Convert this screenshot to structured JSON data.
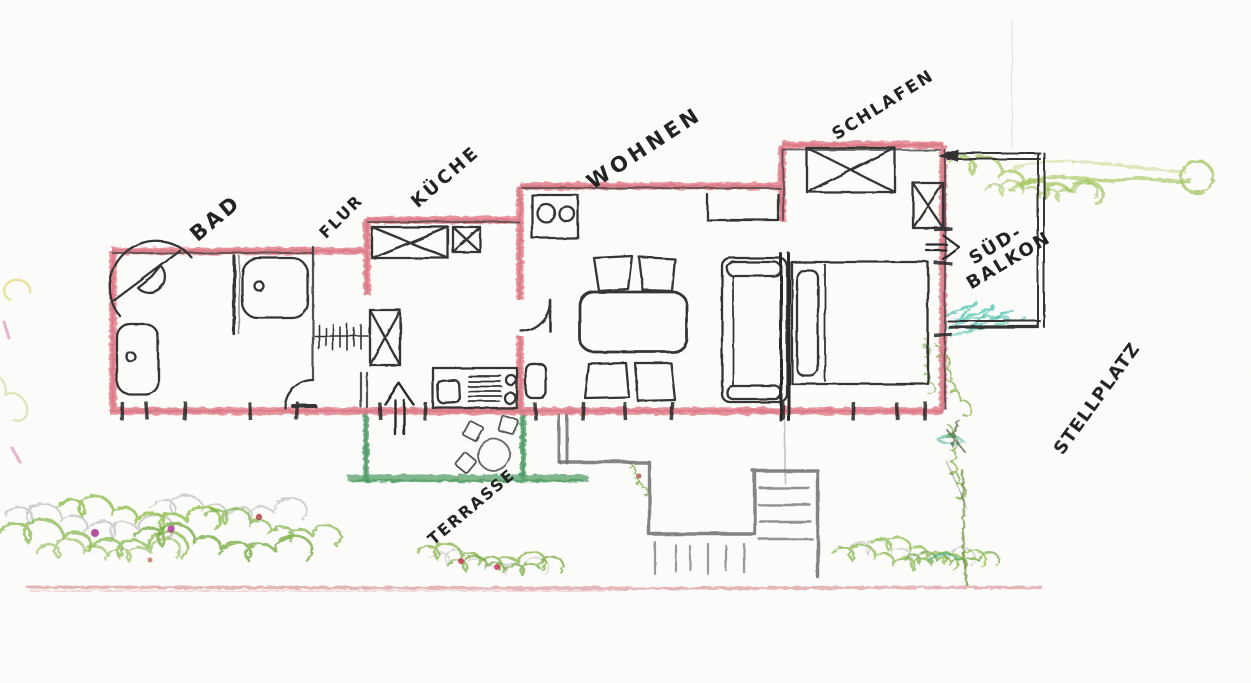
{
  "labels": {
    "bad": "BAD",
    "flur": "FLUR",
    "kueche": "KÜCHE",
    "wohnen": "WOHNEN",
    "schlafen": "SCHLAFEN",
    "sued_balkon_line1": "SÜD-",
    "sued_balkon_line2": "BALKON",
    "terrasse": "TERRASSE",
    "stellplatz": "STELLPLATZ"
  },
  "palette": {
    "wall_red": "#e2808d",
    "wall_red_core": "#cf6a76",
    "pencil_black": "#383838",
    "pencil_gray": "#6f6f6f",
    "crayon_green": "#84b449",
    "terrace_green": "#55a06a",
    "teal": "#35b9a1",
    "flower_magenta": "#a8328c",
    "flower_red": "#c0434f",
    "street_red": "#d4898e"
  }
}
